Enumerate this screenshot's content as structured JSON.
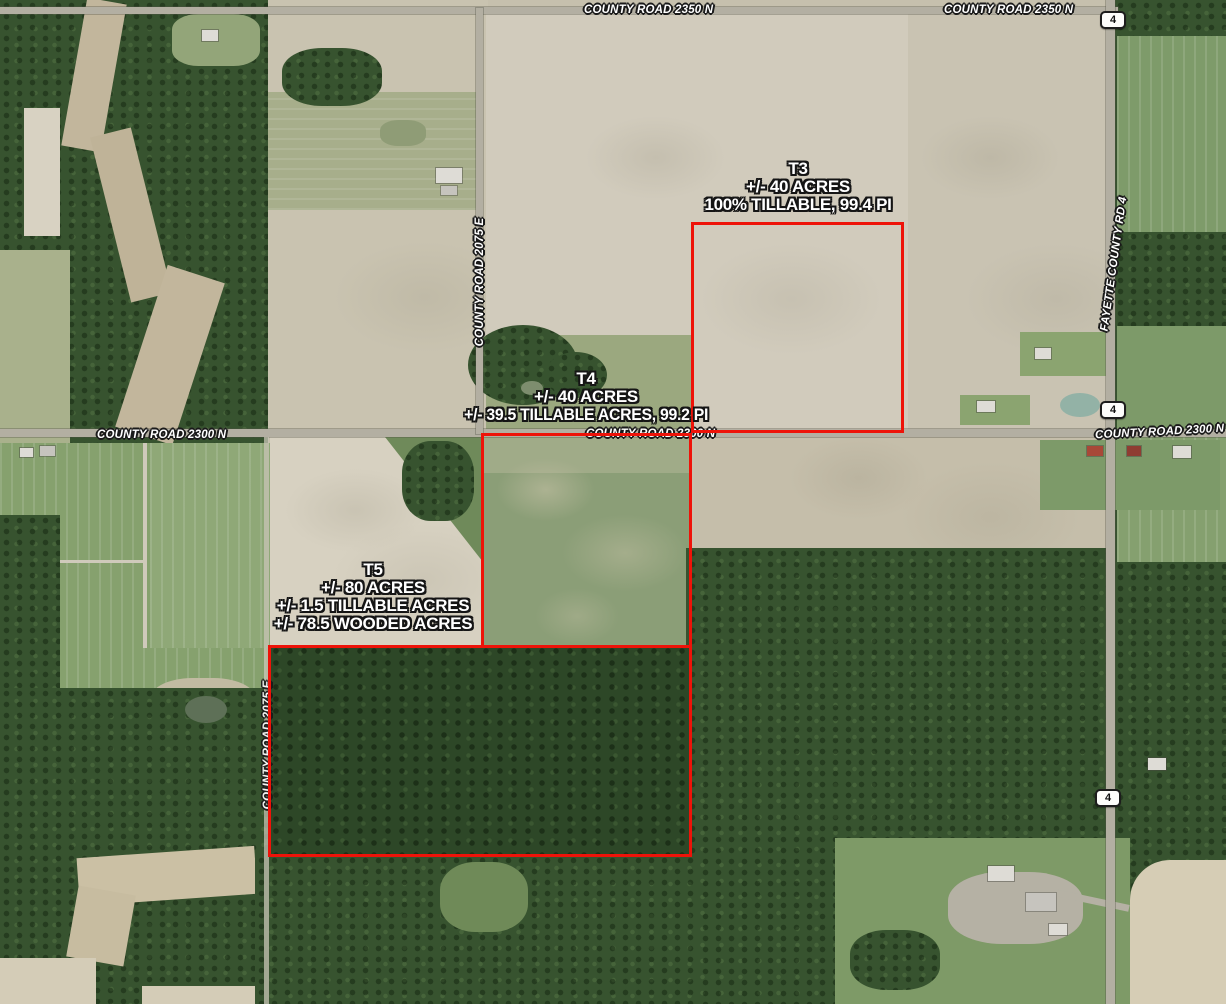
{
  "map": {
    "roads": {
      "cr2350n": "COUNTY ROAD 2350 N",
      "cr2300n": "COUNTY ROAD 2300 N",
      "cr2075e": "COUNTY ROAD 2075 E",
      "fayette_cr4": "FAYETTE COUNTY RD 4"
    },
    "route_shield": "4",
    "tracts": [
      {
        "id": "T3",
        "lines": [
          "T3",
          "+/- 40 ACRES",
          "100% TILLABLE, 99.4 PI"
        ]
      },
      {
        "id": "T4",
        "lines": [
          "T4",
          "+/- 40 ACRES",
          "+/- 39.5 TILLABLE ACRES, 99.2 PI"
        ]
      },
      {
        "id": "T5",
        "lines": [
          "T5",
          "+/- 80 ACRES",
          "+/- 1.5 TILLABLE ACRES",
          "+/- 78.5 WOODED ACRES"
        ]
      }
    ],
    "colors": {
      "parcel_outline": "#ee1309",
      "label_text": "#ffffff",
      "label_halo": "#151515",
      "shield_bg": "#fdfdfb",
      "shield_border": "#1d1d1d",
      "road_surface": "#b3afa2",
      "forest": "#37532f",
      "bare_field": "#d1cbbc"
    }
  }
}
